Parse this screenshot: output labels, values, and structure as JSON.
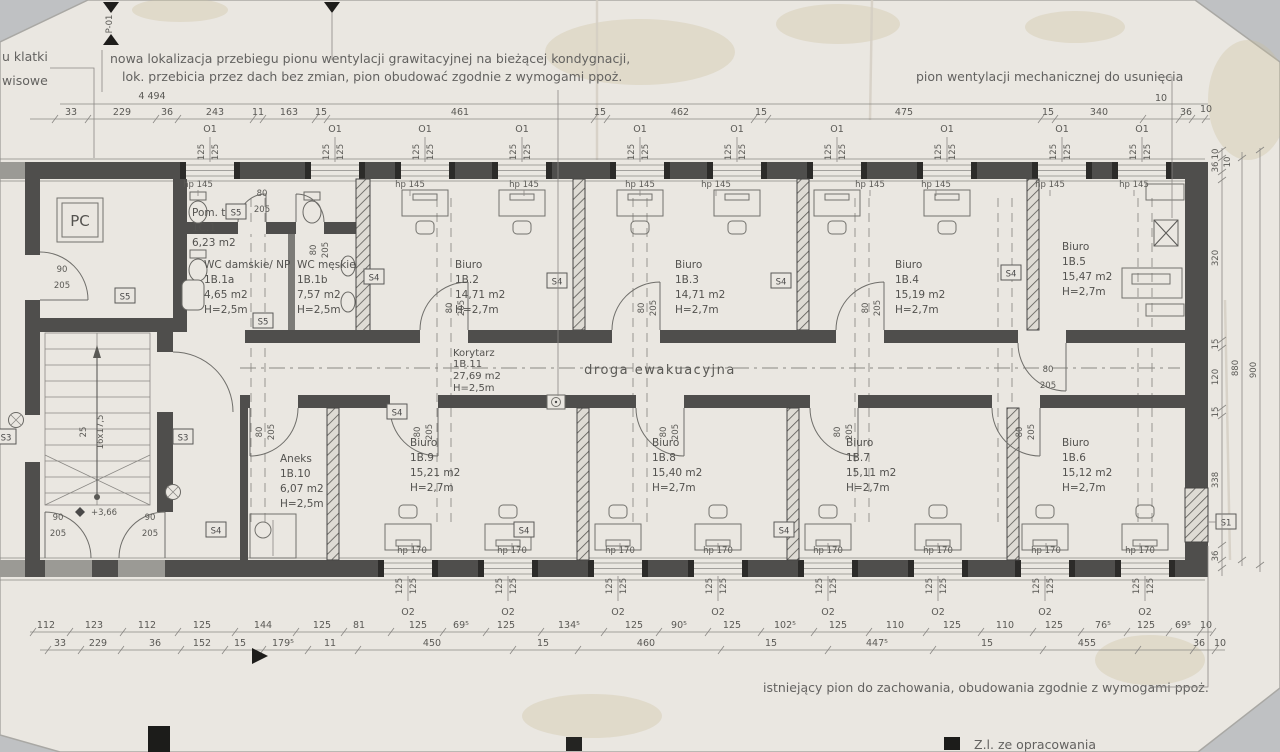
{
  "photo": {
    "paper_color": "#eae7e1",
    "backdrop_color": "#bfc1c3",
    "ink_color": "#4f4e4c"
  },
  "notes": {
    "top_line1": "nowa lokalizacja przebiegu pionu wentylacji grawitacyjnej  na bieżącej kondygnacji,",
    "top_line2": "lok. przebicia przez dach bez zmian, pion obudować zgodnie z wymogami ppoż.",
    "right": "pion wentylacji mechanicznej do usunięcia",
    "bottom": "istniejący pion do zachowania, obudowania zgodnie z wymogami ppoż.",
    "corner_line1": "u klatki",
    "corner_line2": "wisowe",
    "footer_partial": "Z.l. ze opracowania",
    "section_marker": "P-01"
  },
  "rooms": [
    {
      "name": "Pom. tech.",
      "id": "1C.1",
      "area": "6,23 m2",
      "h": ""
    },
    {
      "name": "WC damskie/ NP",
      "id": "1B.1a",
      "area": "4,65 m2",
      "h": "H=2,5m"
    },
    {
      "name": "WC męskie",
      "id": "1B.1b",
      "area": "7,57 m2",
      "h": "H=2,5m"
    },
    {
      "name": "Biuro",
      "id": "1B.2",
      "area": "14,71 m2",
      "h": "H=2,7m"
    },
    {
      "name": "Biuro",
      "id": "1B.3",
      "area": "14,71 m2",
      "h": "H=2,7m"
    },
    {
      "name": "Biuro",
      "id": "1B.4",
      "area": "15,19 m2",
      "h": "H=2,7m"
    },
    {
      "name": "Biuro",
      "id": "1B.5",
      "area": "15,47 m2",
      "h": "H=2,7m"
    },
    {
      "name": "Korytarz",
      "id": "1B.11",
      "area": "27,69 m2",
      "h": "H=2,5m"
    },
    {
      "name": "Aneks",
      "id": "1B.10",
      "area": "6,07 m2",
      "h": "H=2,5m"
    },
    {
      "name": "Biuro",
      "id": "1B.9",
      "area": "15,21 m2",
      "h": "H=2,7m"
    },
    {
      "name": "Biuro",
      "id": "1B.8",
      "area": "15,40 m2",
      "h": "H=2,7m"
    },
    {
      "name": "Biuro",
      "id": "1B.7",
      "area": "15,11 m2",
      "h": "H=2,7m"
    },
    {
      "name": "Biuro",
      "id": "1B.6",
      "area": "15,12 m2",
      "h": "H=2,7m"
    }
  ],
  "corridor_route": "droga ewakuacyjna",
  "tags": {
    "o1": "O1",
    "o2": "O2",
    "win125": "125",
    "hp_top": "hp 145",
    "hp_bottom": "hp 170",
    "s1": "S1",
    "s3": "S3",
    "s4": "S4",
    "s5": "S5"
  },
  "door_dims": {
    "w80": "80",
    "w90": "90",
    "h205": "205"
  },
  "stair": {
    "pc": "PC",
    "steps": "16x17,5",
    "tread": "25",
    "level": "+3,66"
  },
  "dims": {
    "top_total": "4 494",
    "top_row": [
      "33",
      "229",
      "36",
      "243",
      "11",
      "163",
      "15",
      "461",
      "15",
      "462",
      "15",
      "475",
      "15",
      "340",
      "10",
      "36",
      "10"
    ],
    "bottom_row1": [
      "112",
      "123",
      "112",
      "125",
      "144",
      "125",
      "81",
      "125",
      "69⁵",
      "125",
      "134⁵",
      "125",
      "90⁵",
      "125",
      "102⁵",
      "125",
      "110",
      "125",
      "110",
      "125",
      "76⁵",
      "125",
      "69⁵",
      "10"
    ],
    "bottom_row2": [
      "33",
      "229",
      "36",
      "152",
      "15",
      "179⁵",
      "11",
      "450",
      "15",
      "460",
      "15",
      "447⁵",
      "15",
      "455",
      "36",
      "10"
    ],
    "right_inner": [
      "10",
      "36",
      "10",
      "320",
      "15",
      "120",
      "15",
      "338",
      "36"
    ],
    "right_mid": "880",
    "right_outer": "900"
  }
}
